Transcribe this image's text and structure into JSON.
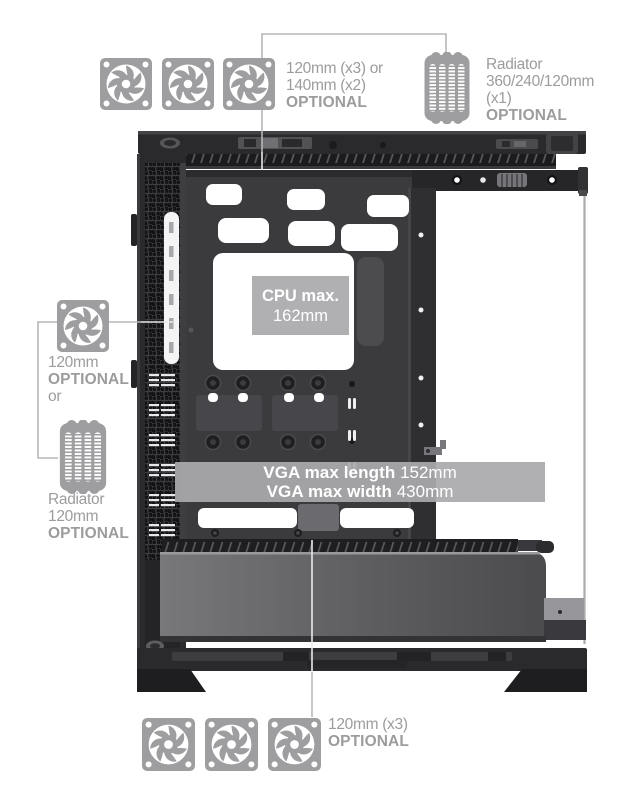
{
  "colors": {
    "annotation": "#9c9c9e",
    "icon_gray": "#9e9ea0",
    "badge_bg": "rgba(170,170,173,0.93)",
    "badge_text": "#ffffff",
    "callout_line": "#b7b7b9",
    "case_dark": "#2a2a2d",
    "case_tray": "#3b3b3e"
  },
  "callouts": {
    "top_fans": {
      "icon": "fan-icon",
      "fan_count": 3,
      "lines": [
        "120mm (x3) or",
        "140mm (x2)",
        "OPTIONAL"
      ]
    },
    "top_radiator": {
      "icon": "radiator-icon",
      "lines": [
        "Radiator",
        "360/240/120mm",
        "(x1)",
        "OPTIONAL"
      ]
    },
    "side_fan": {
      "icon": "fan-icon",
      "lines": [
        "120mm",
        "OPTIONAL",
        "or"
      ]
    },
    "side_radiator": {
      "icon": "radiator-icon",
      "lines": [
        "Radiator",
        "120mm",
        "OPTIONAL"
      ]
    },
    "bottom_fans": {
      "icon": "fan-icon",
      "fan_count": 3,
      "lines": [
        "120mm (x3)",
        "OPTIONAL"
      ]
    }
  },
  "badges": {
    "cpu": {
      "title": "CPU max.",
      "value": "162mm"
    },
    "vga": {
      "rows": [
        {
          "label": "VGA max length",
          "value": "152mm"
        },
        {
          "label": "VGA max width",
          "value": "430mm"
        }
      ]
    }
  }
}
